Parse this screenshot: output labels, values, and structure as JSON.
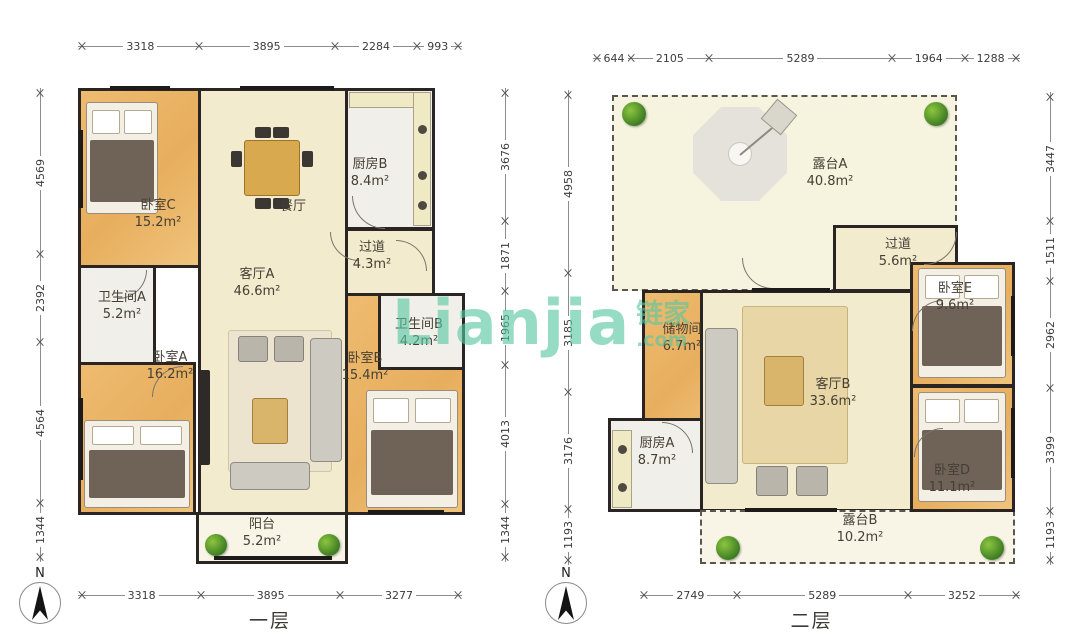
{
  "watermark": {
    "brand": "Lianjia",
    "brand_cn": "链家",
    "domain_suffix": ".com",
    "color": "#57c7a3"
  },
  "floor1": {
    "label": "一层",
    "compass_north": "N",
    "dims_top": [
      "3318",
      "3895",
      "2284",
      "993"
    ],
    "dims_bottom": [
      "3318",
      "3895",
      "3277"
    ],
    "dims_left": [
      "4569",
      "2392",
      "4564",
      "1344"
    ],
    "dims_right": [
      "3676",
      "1871",
      "1965",
      "4013",
      "1344"
    ],
    "rooms": {
      "bedroomC": {
        "name": "卧室C",
        "area": "15.2m²"
      },
      "dining": {
        "name": "餐厅"
      },
      "kitchenB": {
        "name": "厨房B",
        "area": "8.4m²"
      },
      "hallway": {
        "name": "过道",
        "area": "4.3m²"
      },
      "livingA": {
        "name": "客厅A",
        "area": "46.6m²"
      },
      "bathA": {
        "name": "卫生间A",
        "area": "5.2m²"
      },
      "bathB": {
        "name": "卫生间B",
        "area": "4.2m²"
      },
      "bedroomA": {
        "name": "卧室A",
        "area": "16.2m²"
      },
      "bedroomB": {
        "name": "卧室B",
        "area": "15.4m²"
      },
      "balcony": {
        "name": "阳台",
        "area": "5.2m²"
      }
    }
  },
  "floor2": {
    "label": "二层",
    "compass_north": "N",
    "dims_top": [
      "644",
      "2105",
      "5289",
      "1964",
      "1288"
    ],
    "dims_bottom": [
      "2749",
      "5289",
      "3252"
    ],
    "dims_left": [
      "4958",
      "3185",
      "3176",
      "1193"
    ],
    "dims_right": [
      "3447",
      "1511",
      "2962",
      "3399",
      "1193"
    ],
    "rooms": {
      "terraceA": {
        "name": "露台A",
        "area": "40.8m²"
      },
      "hallway": {
        "name": "过道",
        "area": "5.6m²"
      },
      "bedroomE": {
        "name": "卧室E",
        "area": "9.6m²"
      },
      "storage": {
        "name": "储物间",
        "area": "6.7m²"
      },
      "livingB": {
        "name": "客厅B",
        "area": "33.6m²"
      },
      "kitchenA": {
        "name": "厨房A",
        "area": "8.7m²"
      },
      "bedroomD": {
        "name": "卧室D",
        "area": "11.1m²"
      },
      "terraceB": {
        "name": "露台B",
        "area": "10.2m²"
      }
    }
  }
}
